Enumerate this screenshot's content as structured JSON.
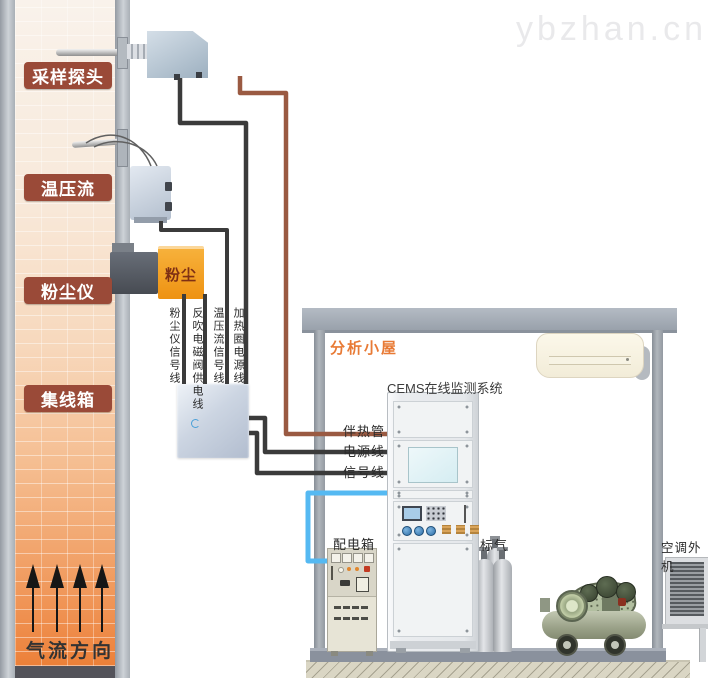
{
  "watermark": "ybzhan.cn",
  "stack": {
    "labels": [
      {
        "id": "sampling-probe",
        "text": "采样探头"
      },
      {
        "id": "temp-pressure-flow",
        "text": "温压流"
      },
      {
        "id": "dust-meter",
        "text": "粉尘仪"
      },
      {
        "id": "junction-box",
        "text": "集线箱"
      }
    ],
    "flow_direction_label": "气流方向",
    "dust_device_text": "粉尘"
  },
  "cables": {
    "vertical_labels": [
      "粉尘仪信号线",
      "反吹电磁阀供电线",
      "温压流信号线",
      "加热圈电源线"
    ],
    "heat_trace_label": "伴热管",
    "power_label": "电源线",
    "signal_label": "信号线",
    "colors": {
      "signal_power": "#3b3b3b",
      "heat_trace": "#9a5a42",
      "sample_blue": "#55b9f2"
    }
  },
  "cabin": {
    "title": "分析小屋",
    "title_color": "#e87a35",
    "cems_cabinet_label": "CEMS在线监测系统",
    "power_distribution_label": "配电箱",
    "standard_gas_label": "标气",
    "ac_outdoor_label": "空调外机"
  },
  "palette": {
    "stack_label_bg": "#9a4a38",
    "dust_orange": "#f2a024",
    "chimney_hot": "#ee8340",
    "roof_gray": "#99a1ab"
  }
}
